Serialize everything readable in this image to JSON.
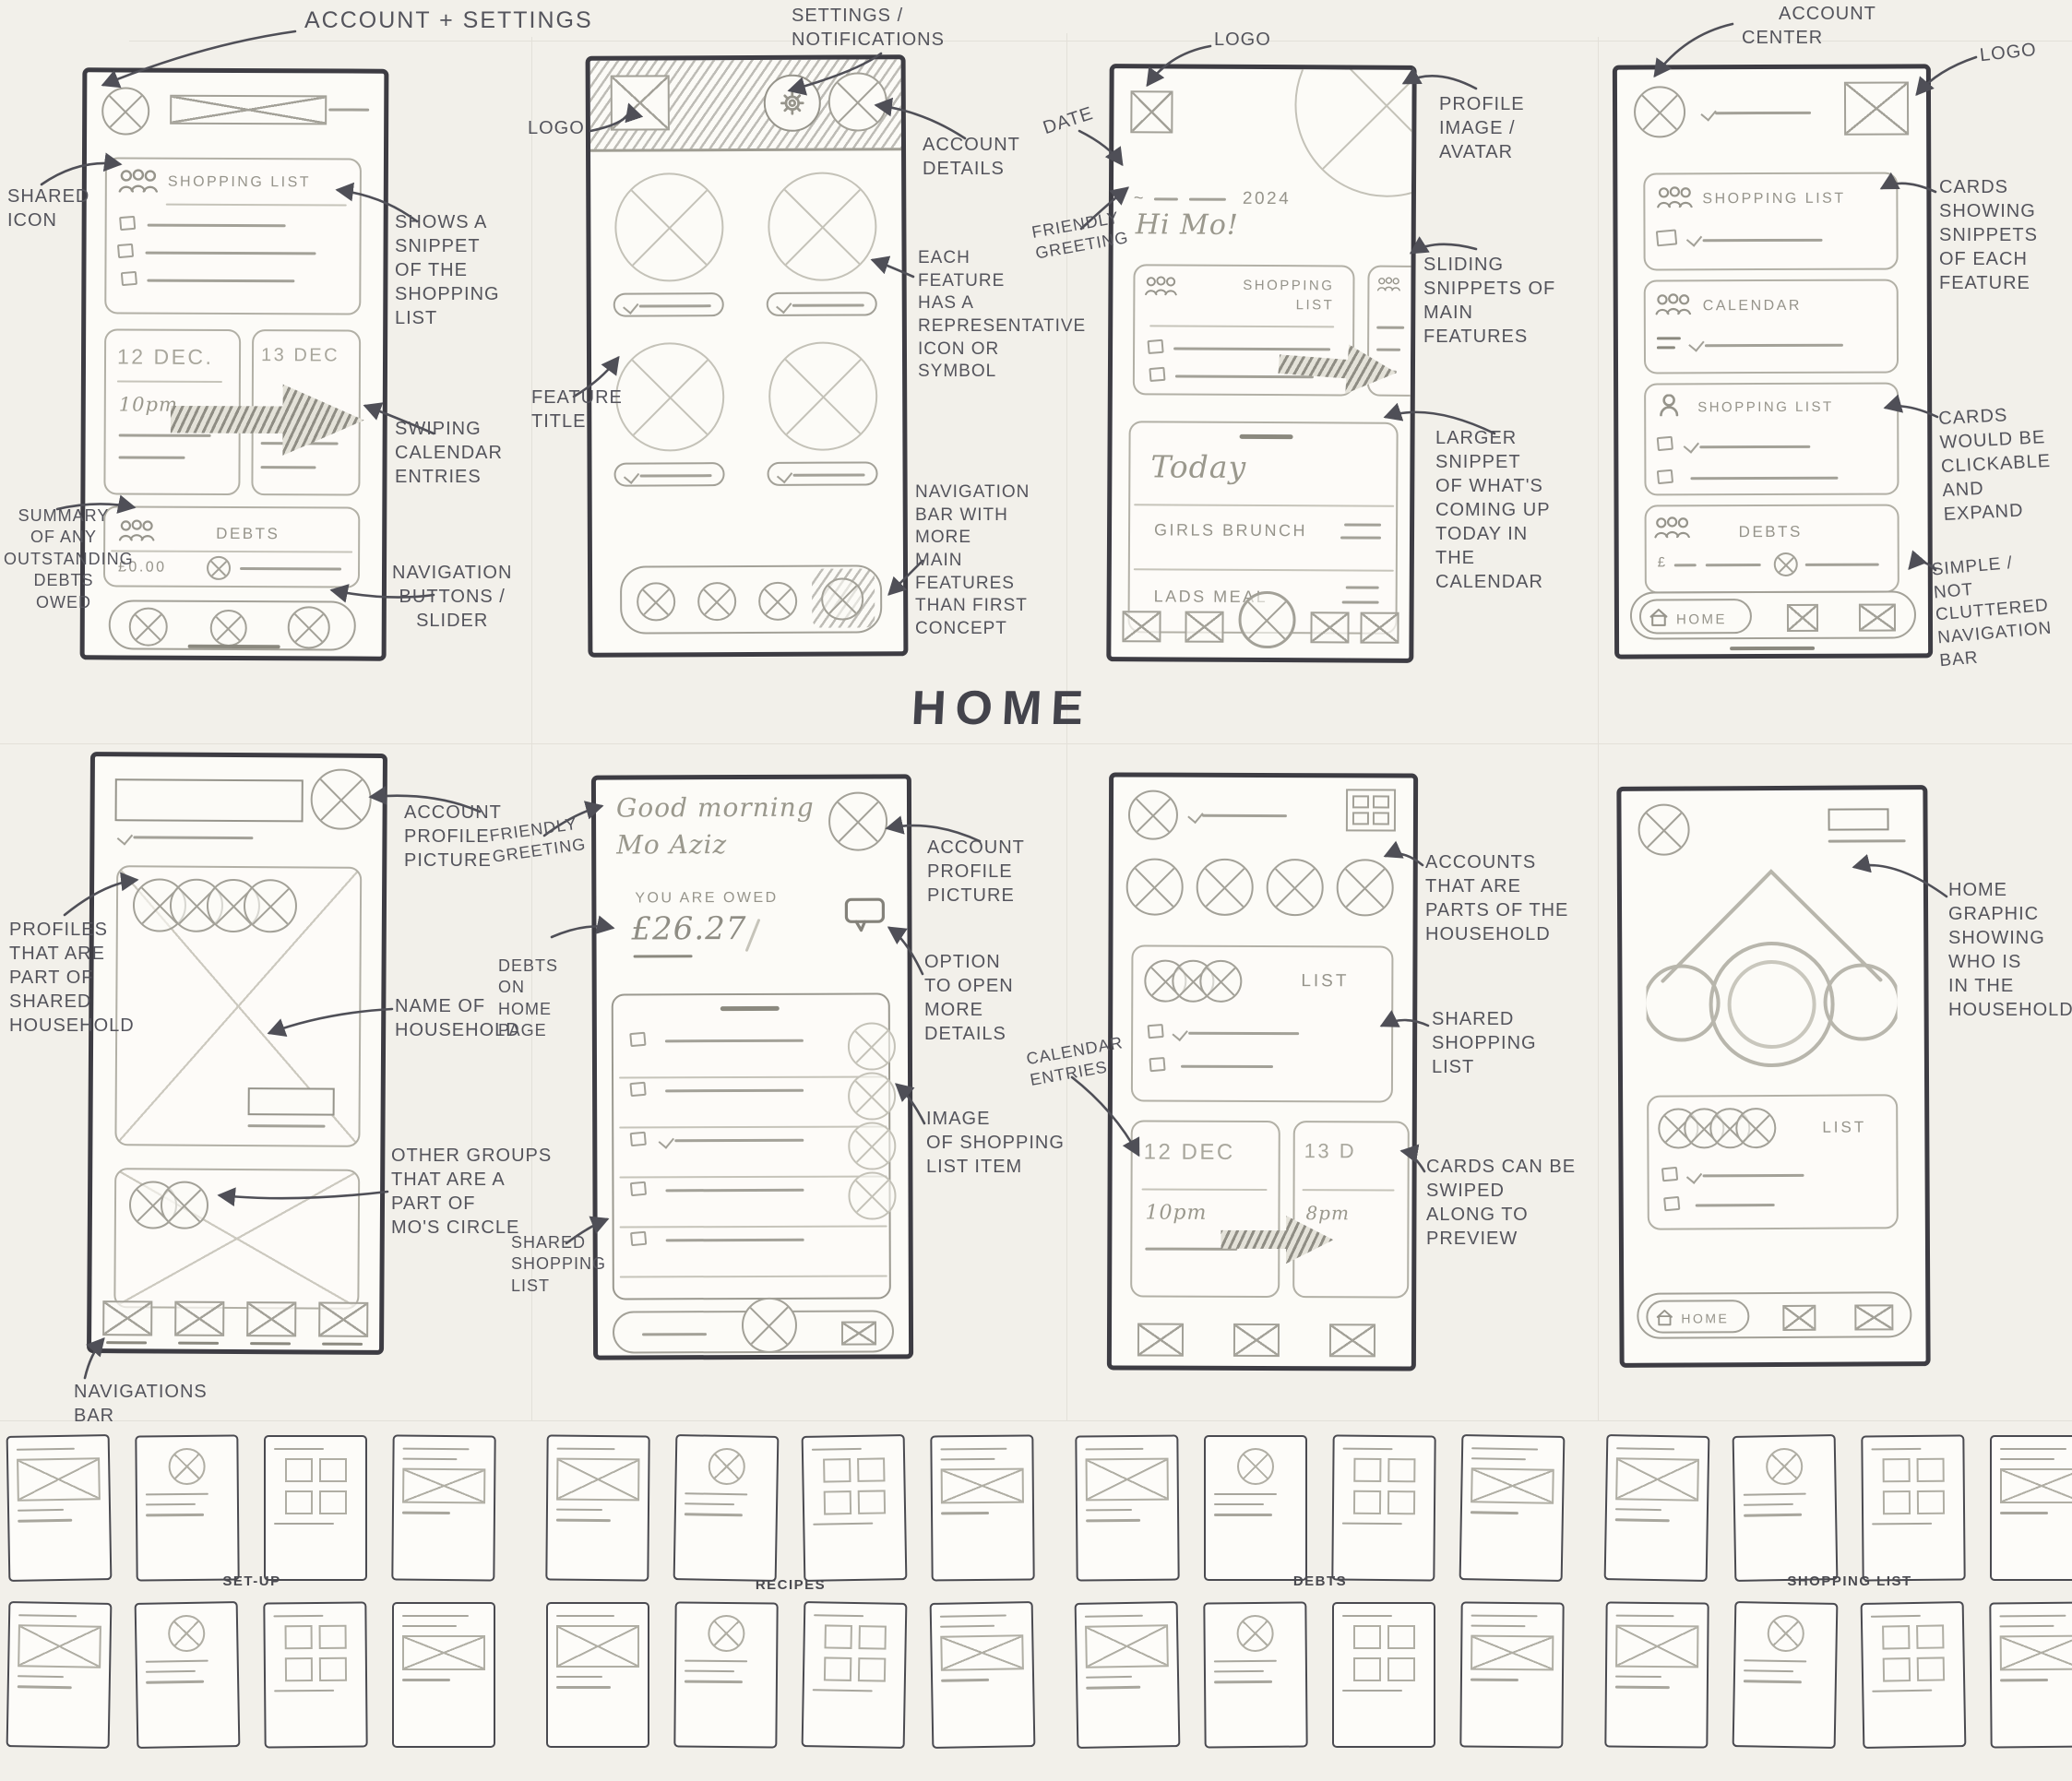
{
  "colors": {
    "ink": "#54545c",
    "pencil": "#96948b",
    "marker": "#3d3c43",
    "paper": "#f2f0ea"
  },
  "page": {
    "home_title": "HOME",
    "section_labels": [
      "SET-UP",
      "RECIPES",
      "DEBTS",
      "SHOPPING LIST"
    ]
  },
  "c1": {
    "annotations": {
      "account_settings": "ACCOUNT + SETTINGS",
      "shared_icon": "SHARED\nICON",
      "snippet": "SHOWS A\nSNIPPET\nOF THE\nSHOPPING\nLIST",
      "swiping": "SWIPING\nCALENDAR\nENTRIES",
      "debts_summary": "SUMMARY\nOF ANY\nOUTSTANDING\nDEBTS\nOWED",
      "nav_buttons": "NAVIGATION\nBUTTONS /\nSLIDER"
    },
    "screen": {
      "shopping_title": "SHOPPING LIST",
      "cal_date_left": "12 DEC.",
      "cal_time_left": "10pm",
      "cal_date_right": "13 DEC",
      "debts_title": "DEBTS",
      "debts_amount": "£0.00"
    }
  },
  "c2": {
    "annotations": {
      "settings_notifications": "SETTINGS /\nNOTIFICATIONS",
      "logo": "LOGO",
      "account_details": "ACCOUNT\nDETAILS",
      "feature_icon": "EACH\nFEATURE\nHAS A\nREPRESENTATIVE\nICON OR\nSYMBOL",
      "feature_title": "FEATURE\nTITLE",
      "nav_bar": "NAVIGATION\nBAR WITH\nMORE\nMAIN\nFEATURES\nTHAN FIRST\nCONCEPT"
    }
  },
  "c3": {
    "annotations": {
      "logo": "LOGO",
      "date": "DATE",
      "friendly_greeting": "FRIENDLY\nGREETING",
      "profile_image": "PROFILE\nIMAGE /\nAVATAR",
      "sliding_snippets": "SLIDING\nSNIPPETS OF\nMAIN\nFEATURES",
      "larger_snippet": "LARGER\nSNIPPET\nOF WHAT'S\nCOMING UP\nTODAY IN\nTHE\nCALENDAR"
    },
    "screen": {
      "year": "2024",
      "greeting": "Hi Mo!",
      "shopping_title": "SHOPPING\nLIST",
      "today_title": "Today",
      "event_1": "GIRLS BRUNCH",
      "event_2": "LADS MEAL"
    }
  },
  "c4": {
    "annotations": {
      "account_center": "ACCOUNT\nCENTER",
      "logo": "LOGO",
      "cards_snippets": "CARDS\nSHOWING\nSNIPPETS\nOF EACH\nFEATURE",
      "cards_clickable": "CARDS\nWOULD BE\nCLICKABLE\nAND\nEXPAND",
      "simple_nav": "SIMPLE /\nNOT CLUTTERED\nNAVIGATION\nBAR"
    },
    "screen": {
      "card_1": "SHOPPING LIST",
      "card_2": "CALENDAR",
      "card_3": "SHOPPING LIST",
      "card_4": "DEBTS",
      "currency": "£",
      "home_label": "HOME"
    }
  },
  "c5": {
    "annotations": {
      "account_profile": "ACCOUNT\nPROFILE\nPICTURE",
      "profiles": "PROFILES\nTHAT ARE\nPART OF\nSHARED\nHOUSEHOLD",
      "household_name": "NAME OF\nHOUSEHOLD",
      "other_groups": "OTHER GROUPS\nTHAT ARE A\nPART OF\nMO'S CIRCLE",
      "nav_bar": "NAVIGATIONS\nBAR"
    }
  },
  "c6": {
    "annotations": {
      "friendly_greeting": "FRIENDLY\nGREETING",
      "account_profile": "ACCOUNT\nPROFILE\nPICTURE",
      "debts_home": "DEBTS\nON\nHOME\nPAGE",
      "open_details": "OPTION\nTO OPEN\nMORE\nDETAILS",
      "list_image": "IMAGE\nOF SHOPPING\nLIST ITEM",
      "shared_list": "SHARED\nSHOPPING\nLIST"
    },
    "screen": {
      "greeting_1": "Good morning",
      "greeting_2": "Mo Aziz",
      "owed_label": "YOU ARE OWED",
      "owed_amount": "£26.27"
    }
  },
  "c7": {
    "annotations": {
      "accounts": "ACCOUNTS\nTHAT ARE\nPARTS OF THE\nHOUSEHOLD",
      "shared_list": "SHARED\nSHOPPING\nLIST",
      "calendar_entries": "CALENDAR\nENTRIES",
      "cards_swiped": "CARDS CAN BE\nSWIPED\nALONG TO\nPREVIEW"
    },
    "screen": {
      "list_title": "LIST",
      "cal_date_left": "12 DEC",
      "cal_time_left": "10pm",
      "cal_date_right": "13 D",
      "cal_time_right": "8pm"
    }
  },
  "c8": {
    "annotations": {
      "home_graphic": "HOME\nGRAPHIC\nSHOWING\nWHO IS\nIN THE\nHOUSEHOLD"
    },
    "screen": {
      "list_title": "LIST",
      "home_label": "HOME"
    }
  },
  "thumbnails": {
    "groups": 4,
    "rows": 2,
    "per_row": 4
  }
}
